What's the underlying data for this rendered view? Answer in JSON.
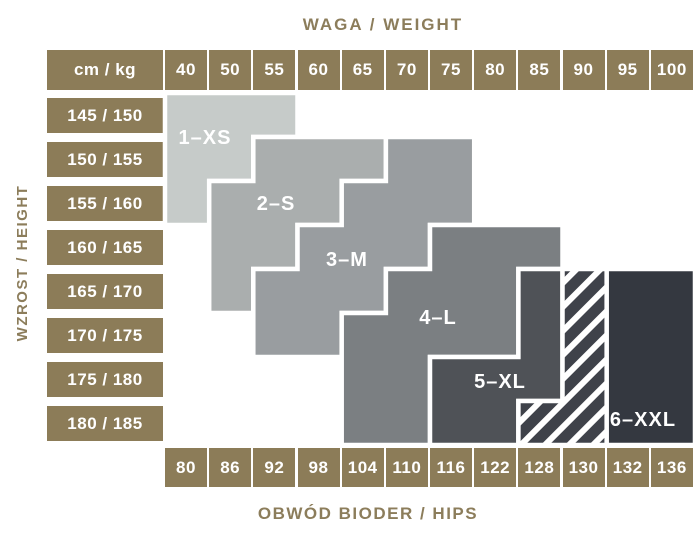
{
  "titles": {
    "weight_axis": "WAGA / WEIGHT",
    "height_axis": "WZROST / HEIGHT",
    "hips_axis": "OBWÓD BIODER / HIPS",
    "corner_cell": "cm / kg"
  },
  "colors": {
    "tan": "#8c7c58",
    "title_text": "#8c7d5b",
    "cell_text": "#ffffff",
    "background": "#ffffff",
    "region_border": "#ffffff",
    "hatch_stripe": "#ffffff"
  },
  "chart_data": {
    "type": "heatmap",
    "title": "WAGA / WEIGHT",
    "x_axis": {
      "title": "WAGA / WEIGHT",
      "unit_label": "cm / kg",
      "categories": [
        "40",
        "50",
        "55",
        "60",
        "65",
        "70",
        "75",
        "80",
        "85",
        "90",
        "95",
        "100"
      ]
    },
    "y_axis": {
      "title": "WZROST / HEIGHT",
      "categories": [
        "145 / 150",
        "150 / 155",
        "155 / 160",
        "160 / 165",
        "165 / 170",
        "170 / 175",
        "175 / 180",
        "180 / 185"
      ]
    },
    "x_axis_bottom": {
      "title": "OBWÓD BIODER / HIPS",
      "categories": [
        "80",
        "86",
        "92",
        "98",
        "104",
        "110",
        "116",
        "122",
        "128",
        "130",
        "132",
        "136"
      ]
    },
    "legend_note": "regions give size for weight column (top), hips column (bottom) and height row (left); rows/cols are 1-based grid indices",
    "regions": [
      {
        "id": "xs",
        "label": "1–XS",
        "color": "#c6cbc9",
        "hatched": false,
        "label_pos": [
          205,
          138
        ],
        "row_spans": [
          {
            "row": 1,
            "cols": [
              1,
              3
            ]
          },
          {
            "row": 2,
            "cols": [
              1,
              2
            ]
          },
          {
            "row": 3,
            "cols": [
              1,
              1
            ]
          }
        ]
      },
      {
        "id": "s",
        "label": "2–S",
        "color": "#aaaeae",
        "hatched": false,
        "label_pos": [
          276,
          204
        ],
        "row_spans": [
          {
            "row": 2,
            "cols": [
              3,
              5
            ]
          },
          {
            "row": 3,
            "cols": [
              2,
              4
            ]
          },
          {
            "row": 4,
            "cols": [
              2,
              3
            ]
          },
          {
            "row": 5,
            "cols": [
              2,
              2
            ]
          }
        ]
      },
      {
        "id": "m",
        "label": "3–M",
        "color": "#999da0",
        "hatched": false,
        "label_pos": [
          347,
          260
        ],
        "row_spans": [
          {
            "row": 2,
            "cols": [
              6,
              7
            ]
          },
          {
            "row": 3,
            "cols": [
              5,
              7
            ]
          },
          {
            "row": 4,
            "cols": [
              4,
              6
            ]
          },
          {
            "row": 5,
            "cols": [
              3,
              5
            ]
          },
          {
            "row": 6,
            "cols": [
              3,
              4
            ]
          }
        ]
      },
      {
        "id": "l",
        "label": "4–L",
        "color": "#7b7f82",
        "hatched": false,
        "label_pos": [
          438,
          318
        ],
        "row_spans": [
          {
            "row": 4,
            "cols": [
              7,
              9
            ]
          },
          {
            "row": 5,
            "cols": [
              6,
              8
            ]
          },
          {
            "row": 6,
            "cols": [
              5,
              8
            ]
          },
          {
            "row": 7,
            "cols": [
              5,
              6
            ]
          },
          {
            "row": 8,
            "cols": [
              5,
              6
            ]
          }
        ]
      },
      {
        "id": "xl",
        "label": "5–XL",
        "color": "#4f5257",
        "hatched": false,
        "label_pos": [
          500,
          382
        ],
        "row_spans": [
          {
            "row": 5,
            "cols": [
              9,
              9
            ]
          },
          {
            "row": 6,
            "cols": [
              9,
              9
            ]
          },
          {
            "row": 7,
            "cols": [
              7,
              9
            ]
          },
          {
            "row": 8,
            "cols": [
              7,
              8
            ]
          }
        ]
      },
      {
        "id": "xl-xxl-overlap",
        "label": "",
        "color": "#3f424a",
        "hatched": true,
        "label_pos": null,
        "row_spans": [
          {
            "row": 5,
            "cols": [
              10,
              10
            ]
          },
          {
            "row": 6,
            "cols": [
              10,
              10
            ]
          },
          {
            "row": 7,
            "cols": [
              10,
              10
            ]
          },
          {
            "row": 8,
            "cols": [
              9,
              10
            ]
          }
        ]
      },
      {
        "id": "xxl",
        "label": "6–XXL",
        "color": "#343840",
        "hatched": false,
        "label_pos": [
          643,
          420
        ],
        "row_spans": [
          {
            "row": 5,
            "cols": [
              11,
              12
            ]
          },
          {
            "row": 6,
            "cols": [
              11,
              12
            ]
          },
          {
            "row": 7,
            "cols": [
              11,
              12
            ]
          },
          {
            "row": 8,
            "cols": [
              11,
              12
            ]
          }
        ]
      }
    ]
  }
}
